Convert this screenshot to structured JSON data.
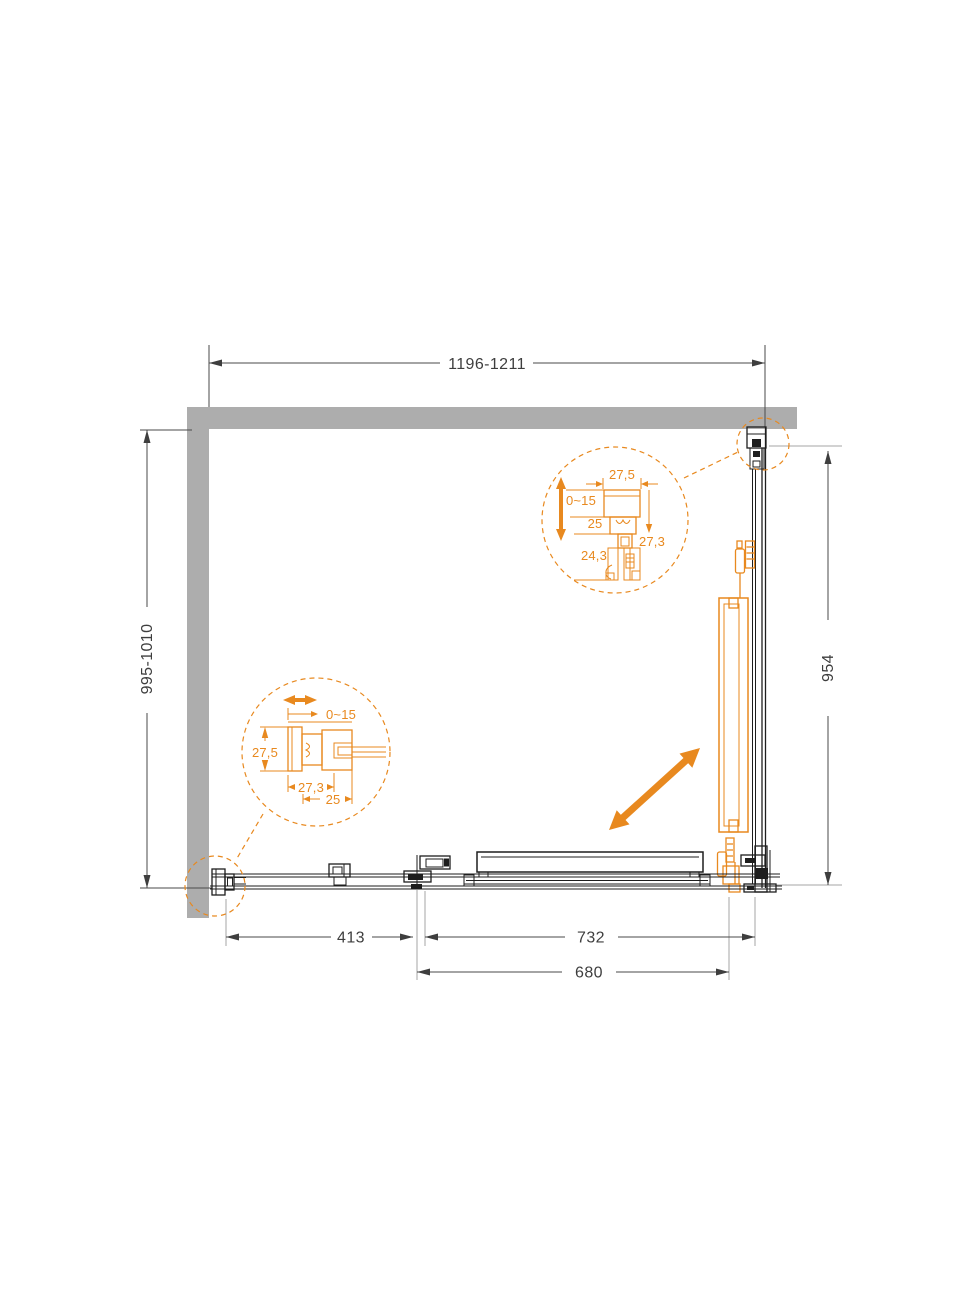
{
  "diagram": {
    "description": "Corner sliding shower enclosure - top view technical drawing",
    "colors": {
      "accent": "#E8891F",
      "wall": "#ADADAD",
      "line": "#1E1E1E",
      "dim": "#3E3E3E",
      "ext": "#A6A6A6"
    },
    "dimensions": {
      "top_width": "1196-1211",
      "left_depth": "995-1010",
      "right_height": "954",
      "bottom_fixed_panel": "413",
      "bottom_opening": "732",
      "bottom_door": "680"
    },
    "detail_top": {
      "width": "27,5",
      "adjustment": "0~15",
      "channel": "25",
      "lower_depth": "24,3",
      "depth": "27,3"
    },
    "detail_bottom": {
      "adjustment": "0~15",
      "height": "27,5",
      "width": "27,3",
      "channel": "25"
    }
  }
}
